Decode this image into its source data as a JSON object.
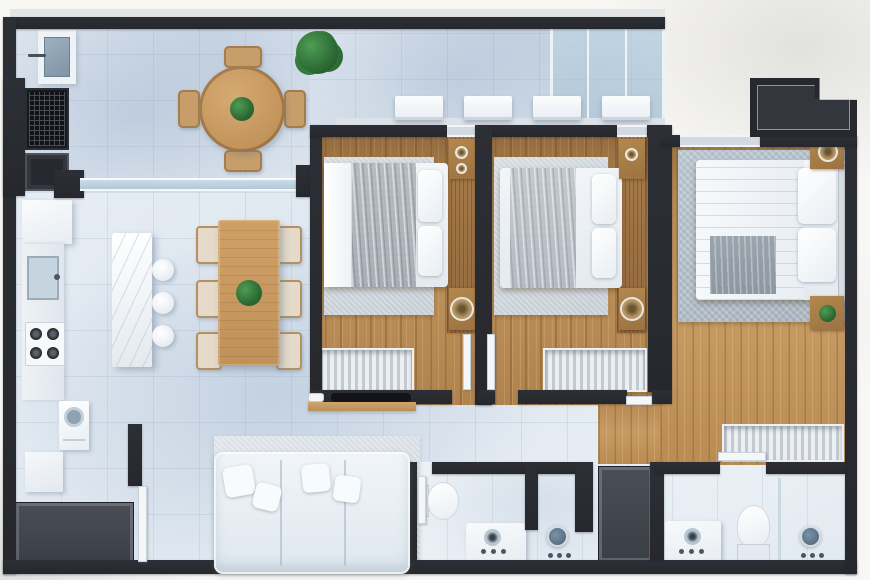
{
  "scene": {
    "type": "apartment-floor-plan-render",
    "view": "top-down 3D architectural render",
    "description": "Three-bedroom apartment floor plan with gourmet balcony, open kitchen and dining, living room, laundry nook, two bathrooms, walk-in closet and service shaft"
  },
  "colors": {
    "bg": "#f8f7f4",
    "wall": "#26282d",
    "tile": "#e2e9f1",
    "tile_light": "#eef3f8",
    "wood_floor": "#ad8050",
    "wood_floor_master": "#b98d55",
    "wood_furniture": "#c59a66",
    "glass": "#aac4d4",
    "rug_light": "#ccd4db",
    "rug_master": "#a9b5c1",
    "white_furniture": "#f2f5f8",
    "dark_cabinet": "#43474e",
    "plant_green": "#2f6f36",
    "shower_metal": "#5e7488"
  },
  "rooms": [
    {
      "name": "gourmet-balcony",
      "floor": "light-tile",
      "furniture": [
        "laundry-sink",
        "barbecue-grill",
        "dark-cabinet",
        "round-wood-table",
        "four-wood-chairs",
        "potted-plant"
      ]
    },
    {
      "name": "technical-ledge",
      "floor": "light-tile",
      "furniture": [
        "glass-enclosure",
        "ac-unit",
        "ac-unit",
        "ac-unit",
        "ac-unit"
      ]
    },
    {
      "name": "kitchen",
      "floor": "light-tile",
      "furniture": [
        "tall-cabinet",
        "counter",
        "sink",
        "four-burner-cooktop",
        "marble-island",
        "bar-stool",
        "bar-stool",
        "bar-stool"
      ]
    },
    {
      "name": "dining-area",
      "floor": "light-tile",
      "furniture": [
        "rectangular-wood-table",
        "six-chairs",
        "table-plant"
      ]
    },
    {
      "name": "living-room",
      "floor": "light-tile",
      "furniture": [
        "area-rug",
        "white-sectional-sofa",
        "throw-pillows",
        "wall-tv",
        "wood-media-shelf"
      ]
    },
    {
      "name": "laundry",
      "floor": "light-tile",
      "furniture": [
        "washing-machine",
        "cabinet",
        "dark-counter"
      ]
    },
    {
      "name": "bedroom-1",
      "floor": "wood",
      "furniture": [
        "area-rug",
        "double-bed",
        "headboard-panel",
        "nightstand",
        "nightstand",
        "lamp",
        "striped-wardrobe",
        "door"
      ]
    },
    {
      "name": "bedroom-2",
      "floor": "wood",
      "furniture": [
        "area-rug",
        "double-bed",
        "headboard-panel",
        "nightstand",
        "nightstand",
        "lamp",
        "striped-wardrobe",
        "door"
      ]
    },
    {
      "name": "master-bedroom",
      "floor": "wood",
      "furniture": [
        "large-gray-rug",
        "double-bed",
        "gray-throw",
        "headboard",
        "nightstand",
        "nightstand",
        "lamp",
        "nightstand-plant",
        "walk-in-wardrobe",
        "door"
      ]
    },
    {
      "name": "bathroom",
      "floor": "white-tile",
      "furniture": [
        "toilet",
        "vanity-sink",
        "shower-stall",
        "door"
      ]
    },
    {
      "name": "ensuite-bathroom",
      "floor": "white-tile",
      "furniture": [
        "vanity-sink",
        "toilet",
        "glass-shower",
        "door"
      ]
    },
    {
      "name": "service-shaft",
      "floor": "none",
      "furniture": []
    }
  ],
  "counts": {
    "ac_units": 4,
    "bar_stools": 3,
    "dining_chairs": 6,
    "balcony_chairs": 4,
    "bedrooms": 3,
    "bathrooms": 2
  }
}
